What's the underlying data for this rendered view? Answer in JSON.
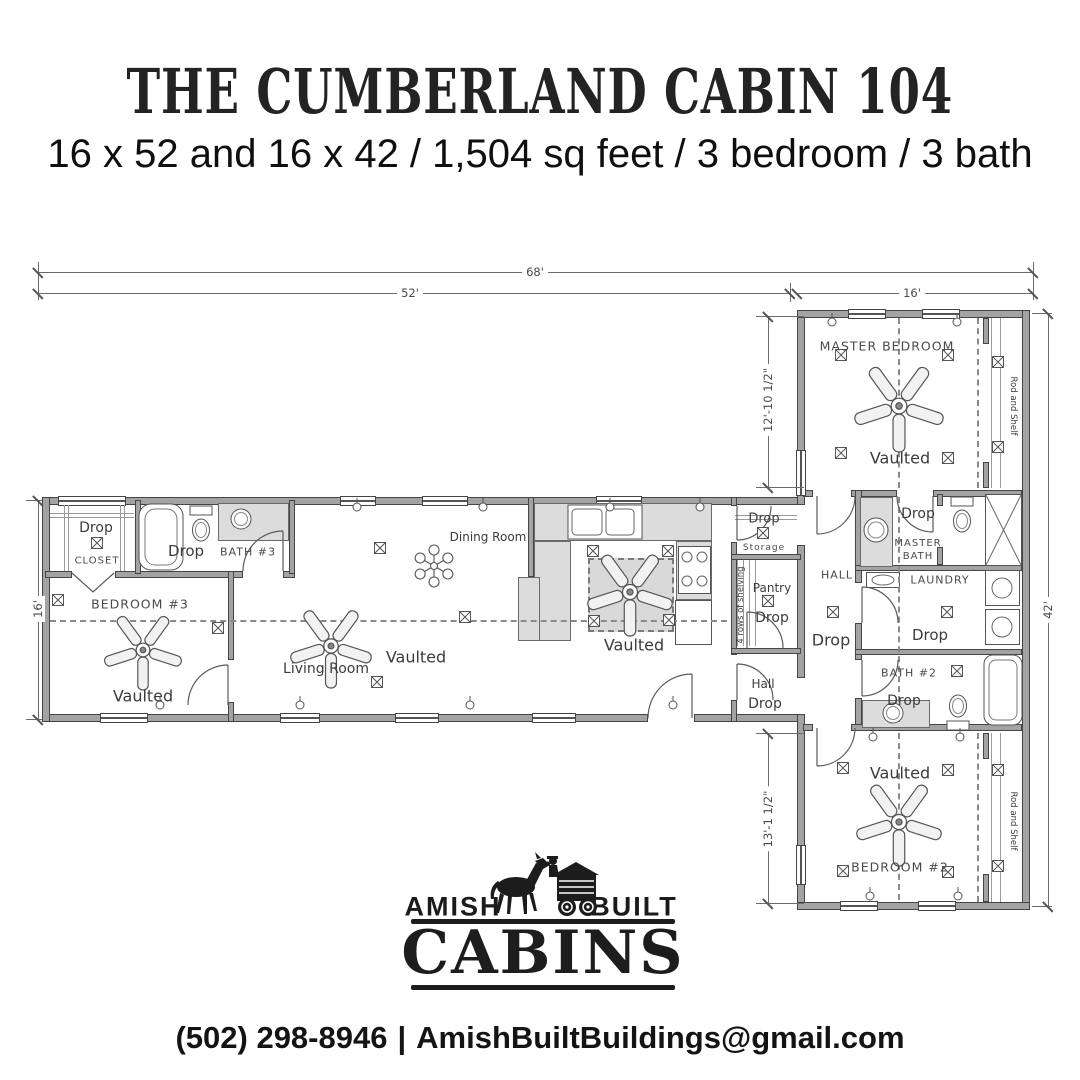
{
  "header": {
    "title": "THE CUMBERLAND CABIN 104",
    "subtitle": "16 x 52 and 16 x 42 / 1,504 sq feet / 3 bedroom / 3 bath"
  },
  "plan": {
    "dimensions": {
      "overall_width": "68'",
      "main_width": "52'",
      "wing_width": "16'",
      "main_depth": "16'",
      "wing_depth": "42'",
      "master_section": "12'-10 1/2\"",
      "bedroom2_section": "13'-1 1/2\""
    },
    "labels": {
      "closet_drop": "Drop",
      "closet": "CLOSET",
      "bath3_drop": "Drop",
      "bath3": "BATH #3",
      "bedroom3": "BEDROOM #3",
      "bedroom3_vaulted": "Vaulted",
      "living_room": "Living Room",
      "living_vaulted": "Vaulted",
      "dining_room": "Dining Room",
      "kitchen_vaulted": "Vaulted",
      "storage_drop": "Drop",
      "storage": "Storage",
      "pantry": "Pantry",
      "pantry_drop": "Drop",
      "pantry_shelving": "4 rows of shelving",
      "hall_small": "Hall",
      "hall_small_drop": "Drop",
      "wing_hall": "HALL",
      "wing_hall_drop": "Drop",
      "master_bedroom": "MASTER BEDROOM",
      "master_vaulted": "Vaulted",
      "rod_shelf_master": "Rod and Shelf",
      "master_bath_drop": "Drop",
      "master_bath": "MASTER BATH",
      "laundry": "LAUNDRY",
      "laundry_drop": "Drop",
      "bath2": "BATH #2",
      "bath2_drop": "Drop",
      "bedroom2_vaulted": "Vaulted",
      "bedroom2": "BEDROOM #2",
      "rod_shelf_bedroom2": "Rod and Shelf"
    }
  },
  "logo": {
    "amish": "AMISH",
    "built": "BUILT",
    "cabins": "CABINS"
  },
  "footer": {
    "phone": "(502) 298-8946",
    "separator": "|",
    "email": "AmishBuiltBuildings@gmail.com"
  },
  "colors": {
    "ink": "#232323",
    "wall": "#a3a3a3",
    "counter": "#dcdcdc"
  }
}
